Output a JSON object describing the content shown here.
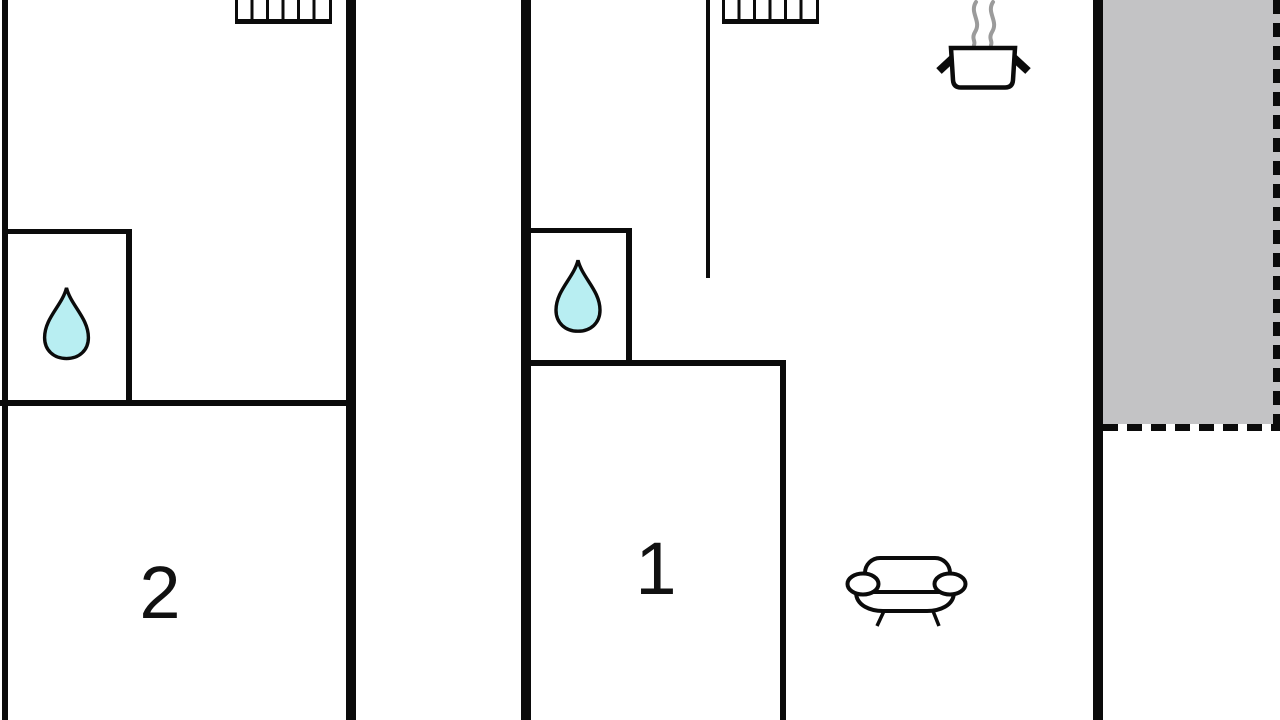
{
  "plan": {
    "type": "apartment-floor-plan",
    "rooms": {
      "room1": {
        "label": "1"
      },
      "room2": {
        "label": "2"
      }
    },
    "features": [
      "radiator-top-left",
      "radiator-top-middle",
      "bathroom-water-drop-left",
      "bathroom-water-drop-middle",
      "kitchen-cooking-pot",
      "living-room-sofa",
      "terrace-dashed-area"
    ]
  },
  "colors": {
    "background": "#ffffff",
    "wall": "#0b0b0b",
    "water_drop": "#b8eef2",
    "terrace": "#c3c3c5",
    "steam": "#9b9b9b",
    "label": "#111111"
  }
}
